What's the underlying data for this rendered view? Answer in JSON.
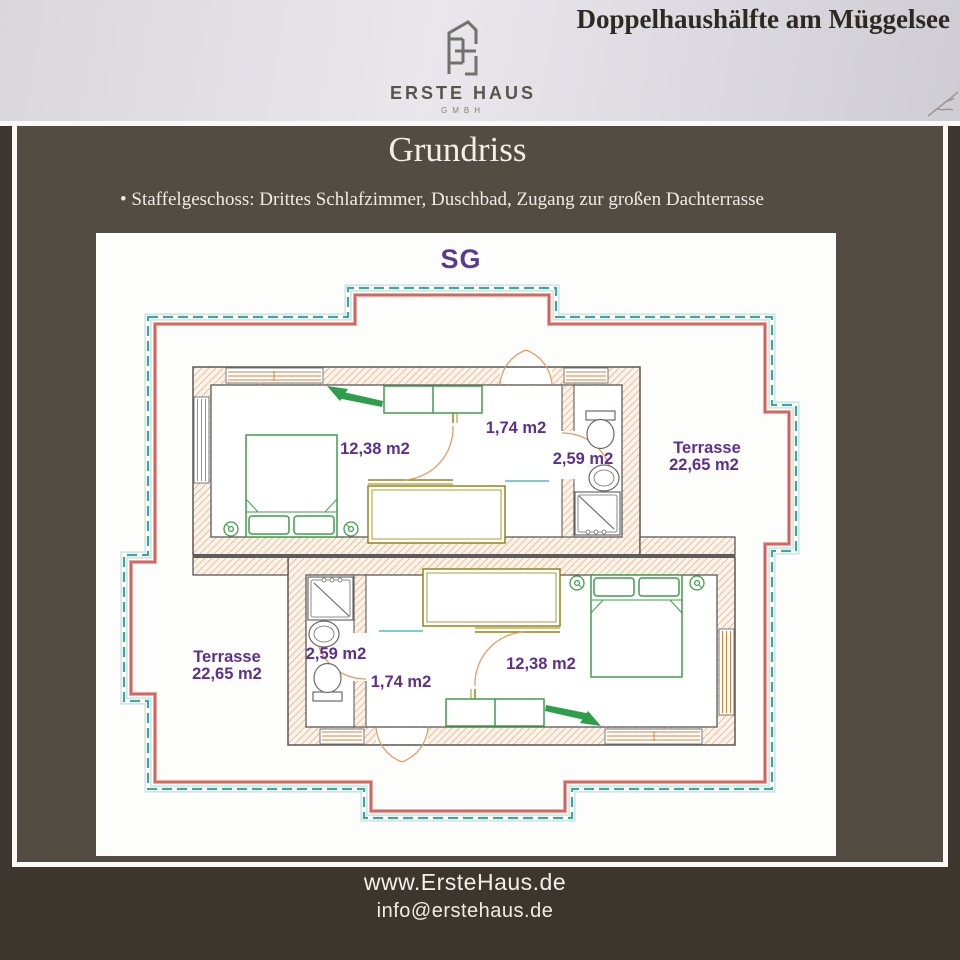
{
  "banner": {
    "title": "Doppelhaushälfte am Müggelsee",
    "logo": {
      "name": "ERSTE HAUS",
      "sub": "GMBH"
    }
  },
  "content": {
    "heading": "Grundriss",
    "bullet": "• Staffelgeschoss: Drittes Schlafzimmer, Duschbad, Zugang zur großen Dachterrasse"
  },
  "plan": {
    "floor_label": "SG",
    "unit_top": {
      "bedroom": "12,38 m2",
      "hall": "1,74 m2",
      "bath": "2,59 m2",
      "terrace_name": "Terrasse",
      "terrace_area": "22,65 m2"
    },
    "unit_bottom": {
      "bedroom": "12,38 m2",
      "hall": "1,74 m2",
      "bath": "2,59 m2",
      "terrace_name": "Terrasse",
      "terrace_area": "22,65 m2"
    }
  },
  "footer": {
    "website": "www.ErsteHaus.de",
    "email": "info@erstehaus.de"
  },
  "colors": {
    "label_purple": "#5e2f8d",
    "terrace_teal": "#43a49c",
    "terrace_red": "#c9534d",
    "furniture_green": "#3f9e4c",
    "partition_olive": "#958313",
    "wall_hatch_orange": "#d9813b",
    "door_arc_orange": "#e49b63",
    "background_brown": "#534c43",
    "banner_gray": "#e9e7ec"
  }
}
